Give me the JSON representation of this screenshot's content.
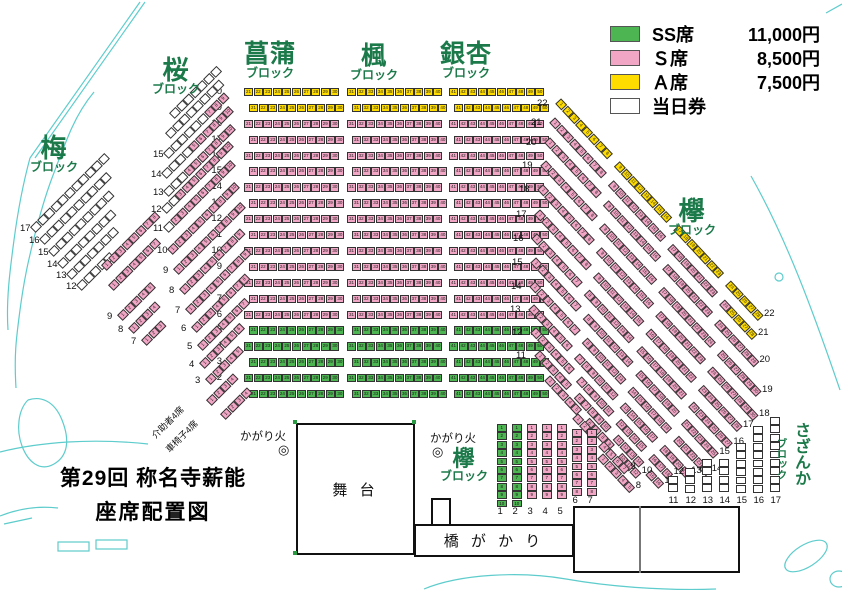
{
  "title": {
    "line1": "第29回 称名寺薪能",
    "line2": "座席配置図"
  },
  "legend": {
    "items": [
      {
        "class": "ss",
        "label": "SS席",
        "price": "11,000円"
      },
      {
        "class": "s",
        "label": "Ｓ席",
        "price": "8,500円"
      },
      {
        "class": "a",
        "label": "Ａ席",
        "price": "7,500円"
      },
      {
        "class": "day",
        "label": "当日券",
        "price": ""
      }
    ]
  },
  "colors": {
    "ss": "#4db551",
    "s": "#f2a6c5",
    "a": "#ffdc00",
    "day": "#ffffff",
    "label_green": "#1c7a4a",
    "deco_cyan": "#5ecccc"
  },
  "blocks": {
    "ume": {
      "name": "梅",
      "sub": "ブロック"
    },
    "sakura": {
      "name": "桜",
      "sub": "ブロック"
    },
    "shobu": {
      "name": "菖蒲",
      "sub": "ブロック"
    },
    "kaede": {
      "name": "楓",
      "sub": "ブロック"
    },
    "icho": {
      "name": "銀杏",
      "sub": "ブロック"
    },
    "keyaki": {
      "name": "欅",
      "sub": "ブロック"
    },
    "keyaki_front": {
      "name": "欅",
      "sub": "ブロック"
    },
    "sazanka": {
      "name": "さざんか",
      "sub": "ブロック"
    }
  },
  "stage": {
    "label": "舞 台"
  },
  "bridge": {
    "label": "橋 が か り"
  },
  "bonfires": [
    {
      "label": "かがり火",
      "symbol": "◎"
    },
    {
      "label": "かがり火",
      "symbol": "◎"
    }
  ],
  "special_rows": [
    {
      "label": "介助者4席",
      "seats": 4
    },
    {
      "label": "車椅子4席",
      "seats": 4
    }
  ],
  "seatmap": {
    "center": {
      "y_bottom": 390,
      "dy": 15.9,
      "stagger": 5,
      "label_x": 204,
      "row_min": 1,
      "row_max": 20,
      "row_classes": [
        {
          "from": 1,
          "to": 5,
          "c": "ss"
        },
        {
          "from": 6,
          "to": 18,
          "c": "s"
        },
        {
          "from": 19,
          "to": 20,
          "c": "a"
        }
      ],
      "columns": [
        {
          "block": "shobu",
          "x": 244,
          "start": 21,
          "count": 10
        },
        {
          "block": "kaede",
          "x": 347,
          "start": 31,
          "count": 10
        },
        {
          "block": "icho",
          "x": 449,
          "start": 41,
          "count": 10
        }
      ]
    },
    "diag_rows": [
      {
        "b": "ume",
        "a": -45,
        "x": 33,
        "y": 226,
        "lab": "17",
        "seg": [
          [
            "day",
            11
          ]
        ]
      },
      {
        "b": "ume",
        "a": -45,
        "x": 42,
        "y": 238,
        "lab": "16",
        "seg": [
          [
            "day",
            10
          ]
        ]
      },
      {
        "b": "ume",
        "a": -45,
        "x": 51,
        "y": 250,
        "lab": "15",
        "seg": [
          [
            "day",
            9
          ]
        ]
      },
      {
        "b": "ume",
        "a": -45,
        "x": 60,
        "y": 262,
        "lab": "14",
        "seg": [
          [
            "day",
            8
          ]
        ]
      },
      {
        "b": "ume",
        "a": -45,
        "x": 69,
        "y": 273,
        "lab": "13",
        "seg": [
          [
            "day",
            7
          ]
        ]
      },
      {
        "b": "ume",
        "a": -45,
        "x": 79,
        "y": 284,
        "lab": "12",
        "seg": [
          [
            "day",
            5
          ]
        ]
      },
      {
        "b": "sakura",
        "a": -45,
        "x": 172,
        "y": 112,
        "seg": [
          [
            "day",
            7
          ]
        ]
      },
      {
        "b": "sakura",
        "a": -45,
        "x": 168,
        "y": 132,
        "seg": [
          [
            "day",
            8
          ]
        ]
      },
      {
        "b": "sakura",
        "a": -45,
        "x": 166,
        "y": 152,
        "lab": "15",
        "seg": [
          [
            "day",
            6
          ],
          [
            "s",
            3
          ]
        ]
      },
      {
        "b": "sakura",
        "a": -45,
        "x": 164,
        "y": 172,
        "lab": "14",
        "seg": [
          [
            "day",
            4
          ],
          [
            "s",
            6
          ]
        ]
      },
      {
        "b": "sakura",
        "a": -45,
        "x": 166,
        "y": 190,
        "lab": "13",
        "seg": [
          [
            "day",
            3
          ],
          [
            "s",
            7
          ]
        ]
      },
      {
        "b": "sakura",
        "a": -45,
        "x": 164,
        "y": 207,
        "lab": "12",
        "seg": [
          [
            "day",
            2
          ],
          [
            "s",
            8
          ]
        ]
      },
      {
        "b": "sakura",
        "a": -45,
        "x": 166,
        "y": 226,
        "lab": "11",
        "seg": [
          [
            "day",
            1
          ],
          [
            "s",
            9
          ]
        ]
      },
      {
        "b": "sakura",
        "a": -45,
        "x": 170,
        "y": 248,
        "lab": "10",
        "seg": [
          [
            "s",
            10
          ]
        ]
      },
      {
        "b": "sakura",
        "a": -45,
        "x": 176,
        "y": 268,
        "lab": "9",
        "seg": [
          [
            "s",
            10
          ]
        ]
      },
      {
        "b": "sakura",
        "a": -45,
        "x": 182,
        "y": 288,
        "lab": "8",
        "seg": [
          [
            "s",
            9
          ]
        ]
      },
      {
        "b": "sakura",
        "a": -45,
        "x": 188,
        "y": 308,
        "lab": "7",
        "seg": [
          [
            "s",
            9
          ]
        ]
      },
      {
        "b": "sakura",
        "a": -45,
        "x": 194,
        "y": 326,
        "lab": "6",
        "seg": [
          [
            "s",
            8
          ]
        ]
      },
      {
        "b": "sakura",
        "a": -45,
        "x": 200,
        "y": 344,
        "lab": "5",
        "seg": [
          [
            "s",
            7
          ]
        ]
      },
      {
        "b": "sakura",
        "a": -45,
        "x": 202,
        "y": 362,
        "lab": "4",
        "seg": [
          [
            "s",
            6
          ]
        ]
      },
      {
        "b": "sakura",
        "a": -45,
        "x": 208,
        "y": 378,
        "lab": "3",
        "seg": [
          [
            "s",
            5
          ]
        ]
      },
      {
        "b": "sakura",
        "a": -45,
        "x": 104,
        "y": 264,
        "seg": [
          [
            "s",
            8
          ]
        ]
      },
      {
        "b": "sakura",
        "a": -45,
        "x": 111,
        "y": 284,
        "seg": [
          [
            "s",
            7
          ]
        ]
      },
      {
        "b": "sakura",
        "a": -45,
        "x": 120,
        "y": 314,
        "lab": "9",
        "seg": [
          [
            "s",
            5
          ]
        ]
      },
      {
        "b": "sakura",
        "a": -45,
        "x": 131,
        "y": 327,
        "lab": "8",
        "seg": [
          [
            "s",
            4
          ]
        ]
      },
      {
        "b": "sakura",
        "a": -45,
        "x": 144,
        "y": 339,
        "lab": "7",
        "seg": [
          [
            "s",
            3
          ]
        ]
      },
      {
        "b": "keyaki",
        "a": 47,
        "x": 558,
        "y": 97,
        "labL": "22",
        "labR": "22",
        "seg": [
          [
            "a",
            8
          ],
          [
            "g",
            1
          ],
          [
            "a",
            8
          ],
          [
            "g",
            1
          ],
          [
            "a",
            7
          ],
          [
            "g",
            1
          ],
          [
            "a",
            5
          ]
        ]
      },
      {
        "b": "keyaki",
        "a": 47,
        "x": 552,
        "y": 116,
        "labL": "21",
        "labR": "21",
        "seg": [
          [
            "s",
            8
          ],
          [
            "g",
            1
          ],
          [
            "s",
            8
          ],
          [
            "g",
            1
          ],
          [
            "s",
            7
          ],
          [
            "g",
            1
          ],
          [
            "s",
            1
          ],
          [
            "a",
            4
          ]
        ]
      },
      {
        "b": "keyaki",
        "a": 47,
        "x": 547,
        "y": 136,
        "labL": "20",
        "labR": "20",
        "seg": [
          [
            "s",
            8
          ],
          [
            "g",
            1
          ],
          [
            "s",
            8
          ],
          [
            "g",
            1
          ],
          [
            "s",
            7
          ],
          [
            "g",
            1
          ],
          [
            "s",
            6
          ]
        ]
      },
      {
        "b": "keyaki",
        "a": 47,
        "x": 543,
        "y": 159,
        "labL": "19",
        "labR": "19",
        "seg": [
          [
            "s",
            8
          ],
          [
            "g",
            1
          ],
          [
            "s",
            8
          ],
          [
            "g",
            1
          ],
          [
            "s",
            8
          ],
          [
            "g",
            1
          ],
          [
            "s",
            6
          ]
        ]
      },
      {
        "b": "keyaki",
        "a": 47,
        "x": 540,
        "y": 183,
        "labL": "18",
        "labR": "18",
        "seg": [
          [
            "s",
            8
          ],
          [
            "g",
            1
          ],
          [
            "s",
            8
          ],
          [
            "g",
            1
          ],
          [
            "s",
            7
          ],
          [
            "g",
            1
          ],
          [
            "s",
            7
          ]
        ]
      },
      {
        "b": "keyaki",
        "a": 47,
        "x": 537,
        "y": 208,
        "labL": "17",
        "labR": "17",
        "seg": [
          [
            "s",
            8
          ],
          [
            "g",
            1
          ],
          [
            "s",
            7
          ],
          [
            "g",
            1
          ],
          [
            "s",
            7
          ],
          [
            "g",
            1
          ],
          [
            "s",
            6
          ]
        ]
      },
      {
        "b": "keyaki",
        "a": 47,
        "x": 534,
        "y": 232,
        "labL": "16",
        "labR": "16",
        "seg": [
          [
            "s",
            7
          ],
          [
            "g",
            1
          ],
          [
            "s",
            7
          ],
          [
            "g",
            1
          ],
          [
            "s",
            7
          ],
          [
            "g",
            1
          ],
          [
            "s",
            6
          ]
        ]
      },
      {
        "b": "keyaki",
        "a": 47,
        "x": 533,
        "y": 256,
        "labL": "15",
        "labR": "15",
        "seg": [
          [
            "s",
            7
          ],
          [
            "g",
            1
          ],
          [
            "s",
            7
          ],
          [
            "g",
            1
          ],
          [
            "s",
            6
          ],
          [
            "g",
            1
          ],
          [
            "s",
            5
          ]
        ]
      },
      {
        "b": "keyaki",
        "a": 47,
        "x": 532,
        "y": 280,
        "labL": "14",
        "labR": "14",
        "seg": [
          [
            "s",
            7
          ],
          [
            "g",
            1
          ],
          [
            "s",
            6
          ],
          [
            "g",
            1
          ],
          [
            "s",
            6
          ],
          [
            "g",
            1
          ],
          [
            "s",
            5
          ]
        ]
      },
      {
        "b": "keyaki",
        "a": 47,
        "x": 531,
        "y": 303,
        "labL": "13",
        "labR": "13",
        "seg": [
          [
            "s",
            6
          ],
          [
            "g",
            1
          ],
          [
            "s",
            6
          ],
          [
            "g",
            1
          ],
          [
            "s",
            5
          ],
          [
            "g",
            1
          ],
          [
            "s",
            4
          ]
        ]
      },
      {
        "b": "keyaki",
        "a": 47,
        "x": 533,
        "y": 326,
        "labL": "12",
        "labR": "12",
        "seg": [
          [
            "s",
            6
          ],
          [
            "g",
            1
          ],
          [
            "s",
            5
          ],
          [
            "g",
            1
          ],
          [
            "s",
            4
          ],
          [
            "g",
            1
          ],
          [
            "s",
            3
          ]
        ]
      },
      {
        "b": "keyaki",
        "a": 47,
        "x": 537,
        "y": 349,
        "labL": "11",
        "labR": "11",
        "seg": [
          [
            "s",
            5
          ],
          [
            "g",
            1
          ],
          [
            "s",
            5
          ],
          [
            "g",
            1
          ],
          [
            "s",
            4
          ],
          [
            "g",
            1
          ],
          [
            "s",
            2
          ]
        ]
      },
      {
        "b": "keyaki",
        "a": 47,
        "x": 547,
        "y": 374,
        "labR": "10",
        "seg": [
          [
            "s",
            5
          ],
          [
            "g",
            1
          ],
          [
            "s",
            4
          ],
          [
            "g",
            1
          ],
          [
            "s",
            3
          ]
        ]
      },
      {
        "b": "keyaki",
        "a": 47,
        "x": 575,
        "y": 412,
        "labR": "9",
        "seg": [
          [
            "s",
            3
          ],
          [
            "g",
            1
          ],
          [
            "s",
            4
          ]
        ]
      },
      {
        "b": "keyaki",
        "a": 47,
        "x": 600,
        "y": 452,
        "labR": "8",
        "seg": [
          [
            "s",
            5
          ]
        ]
      },
      {
        "b": "special",
        "a": -45,
        "x": 209,
        "y": 399,
        "seg": [
          [
            "s",
            4
          ]
        ]
      },
      {
        "b": "special",
        "a": -45,
        "x": 223,
        "y": 413,
        "seg": [
          [
            "s",
            4
          ]
        ]
      }
    ],
    "vcols": [
      {
        "b": "keyaki_front",
        "x": 497,
        "y": 424,
        "n": 10,
        "c": "ss",
        "lab": "1",
        "laby": 507
      },
      {
        "b": "keyaki_front",
        "x": 512,
        "y": 424,
        "n": 10,
        "c": "ss",
        "lab": "2",
        "laby": 507
      },
      {
        "b": "keyaki_front",
        "x": 527,
        "y": 424,
        "n": 9,
        "c": "s",
        "lab": "3",
        "laby": 507
      },
      {
        "b": "keyaki_front",
        "x": 542,
        "y": 424,
        "n": 9,
        "c": "s",
        "lab": "4",
        "laby": 507
      },
      {
        "b": "keyaki_front",
        "x": 557,
        "y": 424,
        "n": 9,
        "c": "s",
        "lab": "5",
        "laby": 507
      },
      {
        "b": "keyaki_front",
        "x": 572,
        "y": 429,
        "n": 8,
        "c": "s",
        "lab": "6",
        "laby": 496
      },
      {
        "b": "keyaki_front",
        "x": 587,
        "y": 429,
        "n": 8,
        "c": "s",
        "lab": "7",
        "laby": 496
      },
      {
        "b": "sazanka",
        "x": 668,
        "y": 476,
        "n": 2,
        "c": "day",
        "lab": "11",
        "laby": 496
      },
      {
        "b": "sazanka",
        "x": 685,
        "y": 468,
        "n": 3,
        "c": "day",
        "lab": "12",
        "laby": 496
      },
      {
        "b": "sazanka",
        "x": 702,
        "y": 459,
        "n": 4,
        "c": "day",
        "lab": "13",
        "laby": 496
      },
      {
        "b": "sazanka",
        "x": 719,
        "y": 459,
        "n": 4,
        "c": "day",
        "lab": "14",
        "laby": 496
      },
      {
        "b": "sazanka",
        "x": 736,
        "y": 443,
        "n": 6,
        "c": "day",
        "lab": "15",
        "laby": 496
      },
      {
        "b": "sazanka",
        "x": 753,
        "y": 426,
        "n": 8,
        "c": "day",
        "lab": "16",
        "laby": 496
      },
      {
        "b": "sazanka",
        "x": 770,
        "y": 417,
        "n": 9,
        "c": "day",
        "lab": "17",
        "laby": 496
      }
    ]
  }
}
